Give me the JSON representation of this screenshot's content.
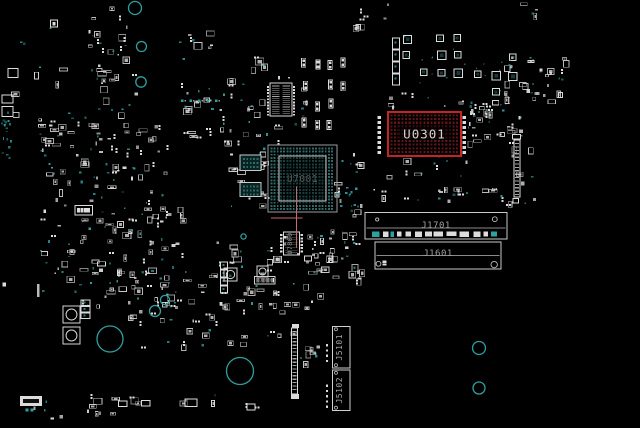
{
  "app": {
    "name": "boardview-canvas"
  },
  "colors": {
    "background": "#000000",
    "part_white": "#dcdcdc",
    "part_dim": "#9a9a9a",
    "teal": "#2fa0a0",
    "hole_teal": "#2f9f9f",
    "highlight_red": "#c62424",
    "highlight_pad": "#5d1515",
    "bga_pad": "#173f3f",
    "bga_pad_outer": "#2d6b6b",
    "crosshair": "#c76a6a",
    "label_bright": "#d4d4d4",
    "label_gray": "#a0a0a0",
    "label_dim": "#585858"
  },
  "crosshair": {
    "vx": 296.6,
    "vy1": 186.5,
    "vy2": 247.5,
    "hy": 218,
    "hx1": 271,
    "hx2": 302.3
  },
  "components": [
    {
      "name": "U0301",
      "label": "U0301",
      "type": "bga",
      "x": 388,
      "y": 112,
      "w": 73,
      "h": 44,
      "pitch": 3.65,
      "padSize": 2.1,
      "pad": "#5d1515",
      "stroke": "#c62424",
      "strokeW": 1.8,
      "labelColor": "#d4d4d4",
      "labelSize": 12.5,
      "backing": true
    },
    {
      "name": "U7001",
      "label": "U7001",
      "type": "bga",
      "x": 268,
      "y": 145,
      "w": 69,
      "h": 67,
      "pitch": 3.2,
      "padSize": 1.9,
      "pad": "#173f3f",
      "padOuter": "#2d6b6b",
      "stroke": "#9b9b9b",
      "strokeW": 1,
      "inner": [
        279,
        156,
        47,
        45
      ],
      "labelColor": "#585858",
      "labelSize": 9.5
    },
    {
      "name": "U7800",
      "label": "U7800",
      "type": "icv",
      "x": 283.5,
      "y": 232,
      "w": 16,
      "h": 23,
      "labelColor": "#8f8f8f",
      "labelSize": 6.5
    },
    {
      "name": "R7000",
      "label": "R7000",
      "type": "boxpads",
      "x": 254.5,
      "y": 276.5,
      "w": 20.5,
      "h": 7.5,
      "pads": 4,
      "labelColor": "#8a8a8a",
      "labelSize": 5
    },
    {
      "name": "J1701",
      "label": "J1701",
      "type": "connh",
      "x": 365,
      "y": 212.5,
      "w": 142,
      "h": 26.5,
      "line": 227.8,
      "padsRow": true,
      "circles": [
        [
          377.2,
          219.5,
          1.6
        ],
        [
          494.8,
          219.2,
          2.4
        ]
      ],
      "labelColor": "#a0a0a0",
      "labelSize": 9,
      "labelY": 225
    },
    {
      "name": "J1601",
      "label": "J1601",
      "type": "connh",
      "x": 375,
      "y": 242,
      "w": 126,
      "h": 27,
      "line": 255.4,
      "circles": [
        [
          378.5,
          263.8,
          2.4
        ],
        [
          494.2,
          264.6,
          3.2
        ]
      ],
      "squares": [
        [
          382.5,
          260.5
        ],
        [
          382.5,
          263.4
        ]
      ],
      "labelColor": "#a0a0a0",
      "labelSize": 9,
      "labelY": 253
    },
    {
      "name": "J5101",
      "label": "J5101",
      "type": "connv",
      "x": 332.5,
      "y": 326.5,
      "w": 17.5,
      "h": 41.5,
      "pins": 4,
      "pinY": 344,
      "labelColor": "#a8a8a8",
      "labelSize": 8
    },
    {
      "name": "J5102",
      "label": "J5102",
      "type": "connv",
      "x": 332.5,
      "y": 370,
      "w": 17.5,
      "h": 40.5,
      "pins": 5,
      "pinY": 384.5,
      "labelColor": "#a8a8a8",
      "labelSize": 8
    }
  ],
  "holes": [
    [
      135,
      8,
      6.5
    ],
    [
      141.5,
      46.5,
      5
    ],
    [
      141,
      82,
      5.2
    ],
    [
      165,
      300,
      4.6
    ],
    [
      110,
      339,
      13
    ],
    [
      155,
      311,
      5.5
    ],
    [
      240,
      371,
      13.5
    ],
    [
      479,
      348,
      6.5
    ],
    [
      479,
      388,
      6
    ],
    [
      243.5,
      236.5,
      2.6
    ]
  ],
  "parts": [
    {
      "t": "padcol",
      "x": 377.6,
      "y": 116,
      "n": 8,
      "dy": 5,
      "w": 3.4,
      "h": 3
    },
    {
      "t": "padcol",
      "x": 462.6,
      "y": 116,
      "n": 8,
      "dy": 5,
      "w": 3.4,
      "h": 3
    },
    {
      "t": "ich",
      "x": 270,
      "y": 83,
      "w": 22,
      "h": 33
    },
    {
      "t": "chipdark",
      "x": 240,
      "y": 155,
      "w": 21,
      "h": 15.5
    },
    {
      "t": "chipdark",
      "x": 240,
      "y": 182.5,
      "w": 21,
      "h": 14
    },
    {
      "t": "box",
      "x": 75,
      "y": 205.5,
      "w": 17.5,
      "h": 9.5,
      "pads": 4
    },
    {
      "t": "vstrip",
      "x": 291.5,
      "y": 328,
      "w": 6,
      "h": 66
    },
    {
      "t": "fill",
      "x": 292,
      "y": 324,
      "w": 7,
      "h": 4
    },
    {
      "t": "fill",
      "x": 291,
      "y": 394,
      "w": 8,
      "h": 5
    },
    {
      "t": "vstrip",
      "x": 514,
      "y": 140,
      "w": 6,
      "h": 57
    },
    {
      "t": "box",
      "x": 512.5,
      "y": 134.5,
      "w": 8,
      "h": 4.5
    },
    {
      "t": "box",
      "x": 513,
      "y": 198.5,
      "w": 5.5,
      "h": 4.5
    },
    {
      "t": "stack",
      "x": 220.5,
      "y": 262,
      "w": 7,
      "h": 7,
      "n": 4
    },
    {
      "t": "stack",
      "x": 392.5,
      "y": 38,
      "w": 7,
      "h": 11,
      "n": 4
    },
    {
      "t": "sqc",
      "x": 63,
      "y": 306,
      "w": 17
    },
    {
      "t": "sqc",
      "x": 63,
      "y": 327,
      "w": 17
    },
    {
      "t": "sqc",
      "x": 224,
      "y": 268,
      "w": 13
    },
    {
      "t": "sqc",
      "x": 257,
      "y": 266,
      "w": 11
    },
    {
      "t": "stack",
      "x": 81,
      "y": 300,
      "w": 9,
      "h": 5.5,
      "n": 3
    },
    {
      "t": "fill",
      "x": 37,
      "y": 284,
      "w": 2.5,
      "h": 13,
      "c": "#b9b9b9"
    },
    {
      "t": "fill",
      "x": 2.5,
      "y": 282.5,
      "w": 3.5,
      "h": 4
    },
    {
      "t": "box",
      "x": 20,
      "y": 396,
      "w": 22,
      "h": 10,
      "solid": true
    },
    {
      "t": "fill",
      "x": 25.5,
      "y": 408.5,
      "w": 3,
      "h": 3,
      "c": "teal"
    },
    {
      "t": "fill",
      "x": 30.5,
      "y": 408.5,
      "w": 3,
      "h": 3,
      "c": "teal"
    },
    {
      "t": "box",
      "x": 118.5,
      "y": 401,
      "w": 8.5,
      "h": 5.5
    },
    {
      "t": "box",
      "x": 141.5,
      "y": 400.5,
      "w": 8.5,
      "h": 5.5
    },
    {
      "t": "box",
      "x": 185,
      "y": 399,
      "w": 12,
      "h": 7.5
    },
    {
      "t": "box",
      "x": 247,
      "y": 404,
      "w": 8,
      "h": 6
    },
    {
      "t": "box",
      "x": 50.5,
      "y": 20,
      "w": 7,
      "h": 7,
      "pads": 1
    },
    {
      "t": "box",
      "x": 8,
      "y": 68.5,
      "w": 10,
      "h": 9
    },
    {
      "t": "box",
      "x": 2,
      "y": 95,
      "w": 11,
      "h": 8
    },
    {
      "t": "box",
      "x": 2,
      "y": 106.5,
      "w": 11,
      "h": 10
    },
    {
      "t": "tealrow",
      "x": 181,
      "y": 99.5,
      "n": 5,
      "dx": 8.5
    }
  ],
  "clusters": [
    {
      "name": "left-mid-upper",
      "x": 38,
      "y": 112,
      "w": 132,
      "h": 96,
      "count": 95,
      "style": "mixed",
      "seed": 11
    },
    {
      "name": "left-mid-lower",
      "x": 40,
      "y": 206,
      "w": 142,
      "h": 100,
      "count": 105,
      "style": "mixed",
      "seed": 22
    },
    {
      "name": "center-top",
      "x": 176,
      "y": 56,
      "w": 132,
      "h": 88,
      "count": 60,
      "style": "mixed",
      "seed": 33
    },
    {
      "name": "right-of-center-res",
      "x": 298,
      "y": 56,
      "w": 62,
      "h": 84,
      "count": 26,
      "style": "res",
      "seed": 44
    },
    {
      "name": "topright-ind-a",
      "x": 398,
      "y": 32,
      "w": 74,
      "h": 66,
      "count": 12,
      "style": "ind",
      "seed": 55
    },
    {
      "name": "topright-ind-b",
      "x": 470,
      "y": 52,
      "w": 52,
      "h": 52,
      "count": 9,
      "style": "ind",
      "seed": 66
    },
    {
      "name": "topright-teal",
      "x": 504,
      "y": 55,
      "w": 60,
      "h": 46,
      "count": 36,
      "style": "mixed",
      "seed": 77
    },
    {
      "name": "right-of-u0301",
      "x": 462,
      "y": 100,
      "w": 60,
      "h": 42,
      "count": 34,
      "style": "mixed",
      "seed": 88
    },
    {
      "name": "below-center",
      "x": 160,
      "y": 240,
      "w": 158,
      "h": 64,
      "count": 55,
      "style": "mixed",
      "seed": 99
    },
    {
      "name": "right-of-u7800",
      "x": 305,
      "y": 228,
      "w": 55,
      "h": 52,
      "count": 40,
      "style": "mixed",
      "seed": 111
    },
    {
      "name": "above-j1701",
      "x": 372,
      "y": 186,
      "w": 132,
      "h": 14,
      "count": 20,
      "style": "mixed",
      "seed": 122
    },
    {
      "name": "bottomleft",
      "x": 128,
      "y": 298,
      "w": 128,
      "h": 50,
      "count": 36,
      "style": "mixed",
      "seed": 133
    },
    {
      "name": "bottom-strip",
      "x": 18,
      "y": 394,
      "w": 244,
      "h": 24,
      "count": 24,
      "style": "mixed",
      "seed": 144
    },
    {
      "name": "left-edge-vias",
      "x": 1,
      "y": 112,
      "w": 9,
      "h": 46,
      "count": 16,
      "style": "teal",
      "seed": 155
    },
    {
      "name": "right-of-u7001",
      "x": 334,
      "y": 150,
      "w": 26,
      "h": 66,
      "count": 14,
      "style": "mixed",
      "seed": 166
    },
    {
      "name": "u7001-teal-trail",
      "x": 336,
      "y": 186,
      "w": 24,
      "h": 32,
      "count": 12,
      "style": "teal",
      "seed": 177
    },
    {
      "name": "below-u0301",
      "x": 378,
      "y": 156,
      "w": 96,
      "h": 22,
      "count": 12,
      "style": "mixed",
      "seed": 188
    },
    {
      "name": "above-u0301",
      "x": 386,
      "y": 92,
      "w": 92,
      "h": 18,
      "count": 12,
      "style": "mixed",
      "seed": 199
    },
    {
      "name": "right-conn-bits",
      "x": 506,
      "y": 126,
      "w": 28,
      "h": 80,
      "count": 12,
      "style": "mixed",
      "seed": 211
    },
    {
      "name": "top-mid-bits",
      "x": 178,
      "y": 20,
      "w": 56,
      "h": 28,
      "count": 8,
      "style": "mixed",
      "seed": 222
    },
    {
      "name": "topleft-sparse",
      "x": 2,
      "y": 16,
      "w": 62,
      "h": 100,
      "count": 10,
      "style": "mixed",
      "seed": 233
    },
    {
      "name": "j5101-left-bits",
      "x": 298,
      "y": 340,
      "w": 20,
      "h": 26,
      "count": 9,
      "style": "mixed",
      "seed": 244
    },
    {
      "name": "mid-bottom-bits",
      "x": 262,
      "y": 300,
      "w": 46,
      "h": 36,
      "count": 8,
      "style": "mixed",
      "seed": 255
    },
    {
      "name": "topright-far-bits",
      "x": 520,
      "y": 2,
      "w": 16,
      "h": 12,
      "count": 4,
      "style": "mixed",
      "seed": 266
    },
    {
      "name": "top-cluster",
      "x": 88,
      "y": 6,
      "w": 50,
      "h": 70,
      "count": 26,
      "style": "mixed",
      "seed": 277
    },
    {
      "name": "top-cluster-lower",
      "x": 95,
      "y": 76,
      "w": 40,
      "h": 34,
      "count": 12,
      "style": "mixed",
      "seed": 288
    },
    {
      "name": "left-of-u7001",
      "x": 228,
      "y": 146,
      "w": 38,
      "h": 62,
      "count": 20,
      "style": "mixed",
      "seed": 299
    },
    {
      "name": "top-edge-bits",
      "x": 348,
      "y": 0,
      "w": 60,
      "h": 26,
      "count": 8,
      "style": "mixed",
      "seed": 311
    }
  ]
}
